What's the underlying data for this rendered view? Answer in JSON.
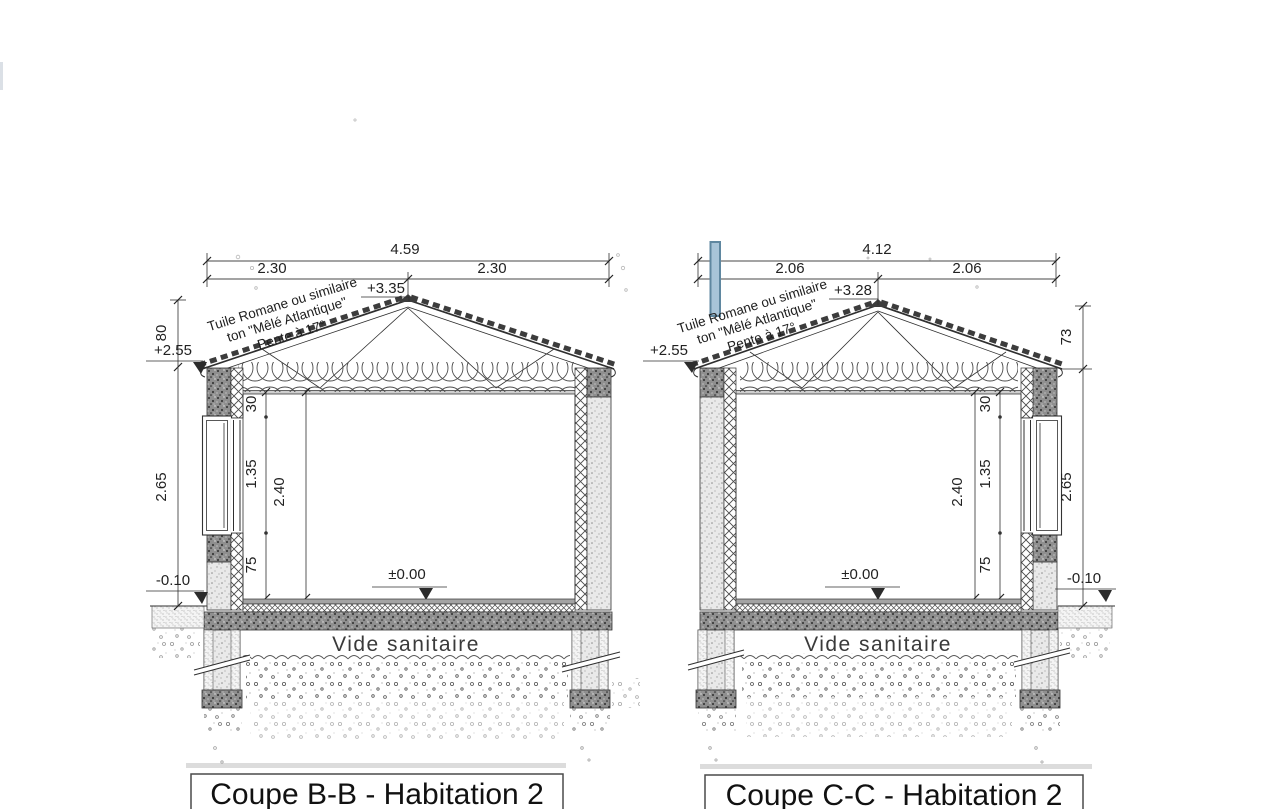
{
  "colors": {
    "line": "#2f2f2f",
    "highlight_fill": "#a8c4d8",
    "highlight_border": "#5f87a0"
  },
  "sections": {
    "bb": {
      "title": "Coupe B-B - Habitation 2",
      "dims": {
        "total_width": "4.59",
        "left_half": "2.30",
        "right_half": "2.30",
        "ridge_level": "+3.35",
        "eave_level": "+2.55",
        "roof_rise": "80",
        "facade_height": "2.65",
        "ground_level": "-0.10",
        "floor_level": "±0.00",
        "lintel_drop": "30",
        "window_height": "1.35",
        "room_height": "2.40",
        "sill_height": "75"
      },
      "notes": {
        "roof_note_1": "Tuile Romane ou similaire",
        "roof_note_2": "ton \"Mêlé Atlantique\"",
        "roof_note_3": "Pente à 17°",
        "crawl_space": "Vide sanitaire"
      }
    },
    "cc": {
      "title": "Coupe C-C - Habitation 2",
      "dims": {
        "total_width": "4.12",
        "left_half": "2.06",
        "right_half": "2.06",
        "ridge_level": "+3.28",
        "eave_level": "+2.55",
        "roof_rise": "73",
        "facade_height": "2.65",
        "ground_level": "-0.10",
        "floor_level": "±0.00",
        "lintel_drop": "30",
        "window_height": "1.35",
        "room_height": "2.40",
        "sill_height": "75"
      },
      "notes": {
        "roof_note_1": "Tuile Romane ou similaire",
        "roof_note_2": "ton \"Mêlé Atlantique\"",
        "roof_note_3": "Pente à 17°",
        "crawl_space": "Vide sanitaire"
      }
    }
  }
}
